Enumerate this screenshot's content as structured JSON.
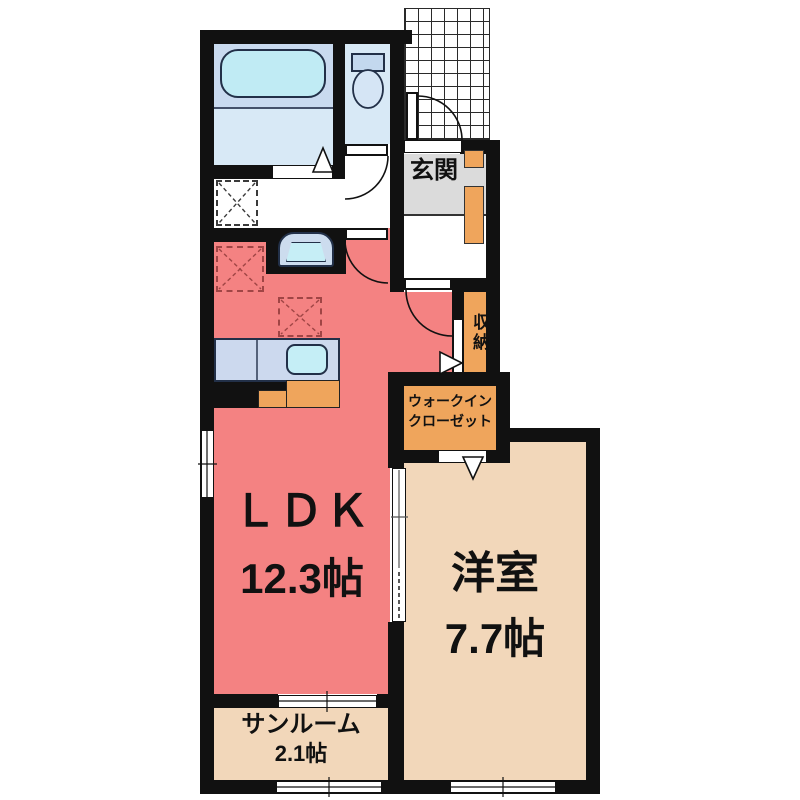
{
  "plan": {
    "type": "japanese-apartment-floorplan",
    "rooms": {
      "genkan_label": "玄関",
      "storage_label": "収納",
      "wic_line1": "ウォークイン",
      "wic_line2": "クローゼット",
      "ldk_name": "ＬＤＫ",
      "ldk_size": "12.3帖",
      "western_name": "洋室",
      "western_size": "7.7帖",
      "sunroom_name": "サンルーム",
      "sunroom_size": "2.1帖"
    },
    "fixtures": [
      "bathtub",
      "shower-floor",
      "toilet",
      "washbasin",
      "kitchen-counter",
      "kitchen-sink",
      "washing-machine-space",
      "refrigerator-space",
      "cupboard-space",
      "shoe-cabinet",
      "entry-porch-tiles",
      "sliding-door",
      "hinged-door",
      "folding-door",
      "window"
    ],
    "colors": {
      "wall": "#111111",
      "ldk": "#f48282",
      "western_room": "#f2d7ba",
      "sunroom": "#f2d7ba",
      "closet_orange": "#efa55c",
      "genkan_gray": "#dbdbdb",
      "bath_blue": "#c9daef",
      "water_blue": "#d8e9f6",
      "tub_cyan": "#c0ebf4"
    }
  }
}
